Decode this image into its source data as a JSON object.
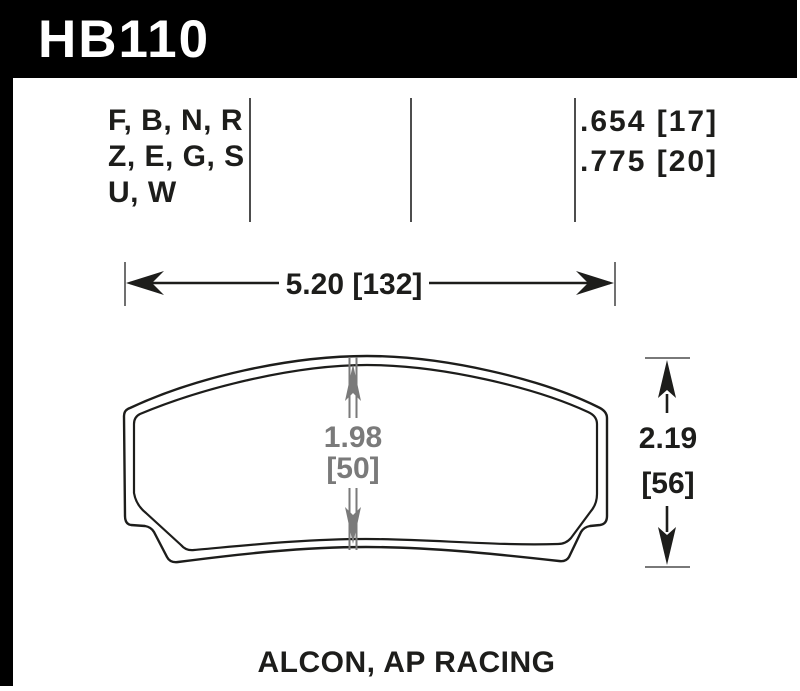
{
  "header": {
    "part_number": "HB110"
  },
  "compounds": {
    "lines": [
      "F, B, N, R",
      "Z, E, G, S",
      "U, W"
    ]
  },
  "thickness": {
    "lines": [
      ".654 [17]",
      ".775 [20]"
    ]
  },
  "dimensions": {
    "width": {
      "label": "5.20 [132]"
    },
    "height": {
      "value_in": "2.19",
      "value_mm": "[56]"
    },
    "center": {
      "value_in": "1.98",
      "value_mm": "[50]"
    }
  },
  "caption": {
    "applications": "ALCON, AP RACING"
  },
  "colors": {
    "header_bg": "#000000",
    "header_fg": "#ffffff",
    "line_black": "#1d1d1b",
    "dim_gray": "#7a7a7a",
    "divider_gray": "#4d4d4d"
  }
}
